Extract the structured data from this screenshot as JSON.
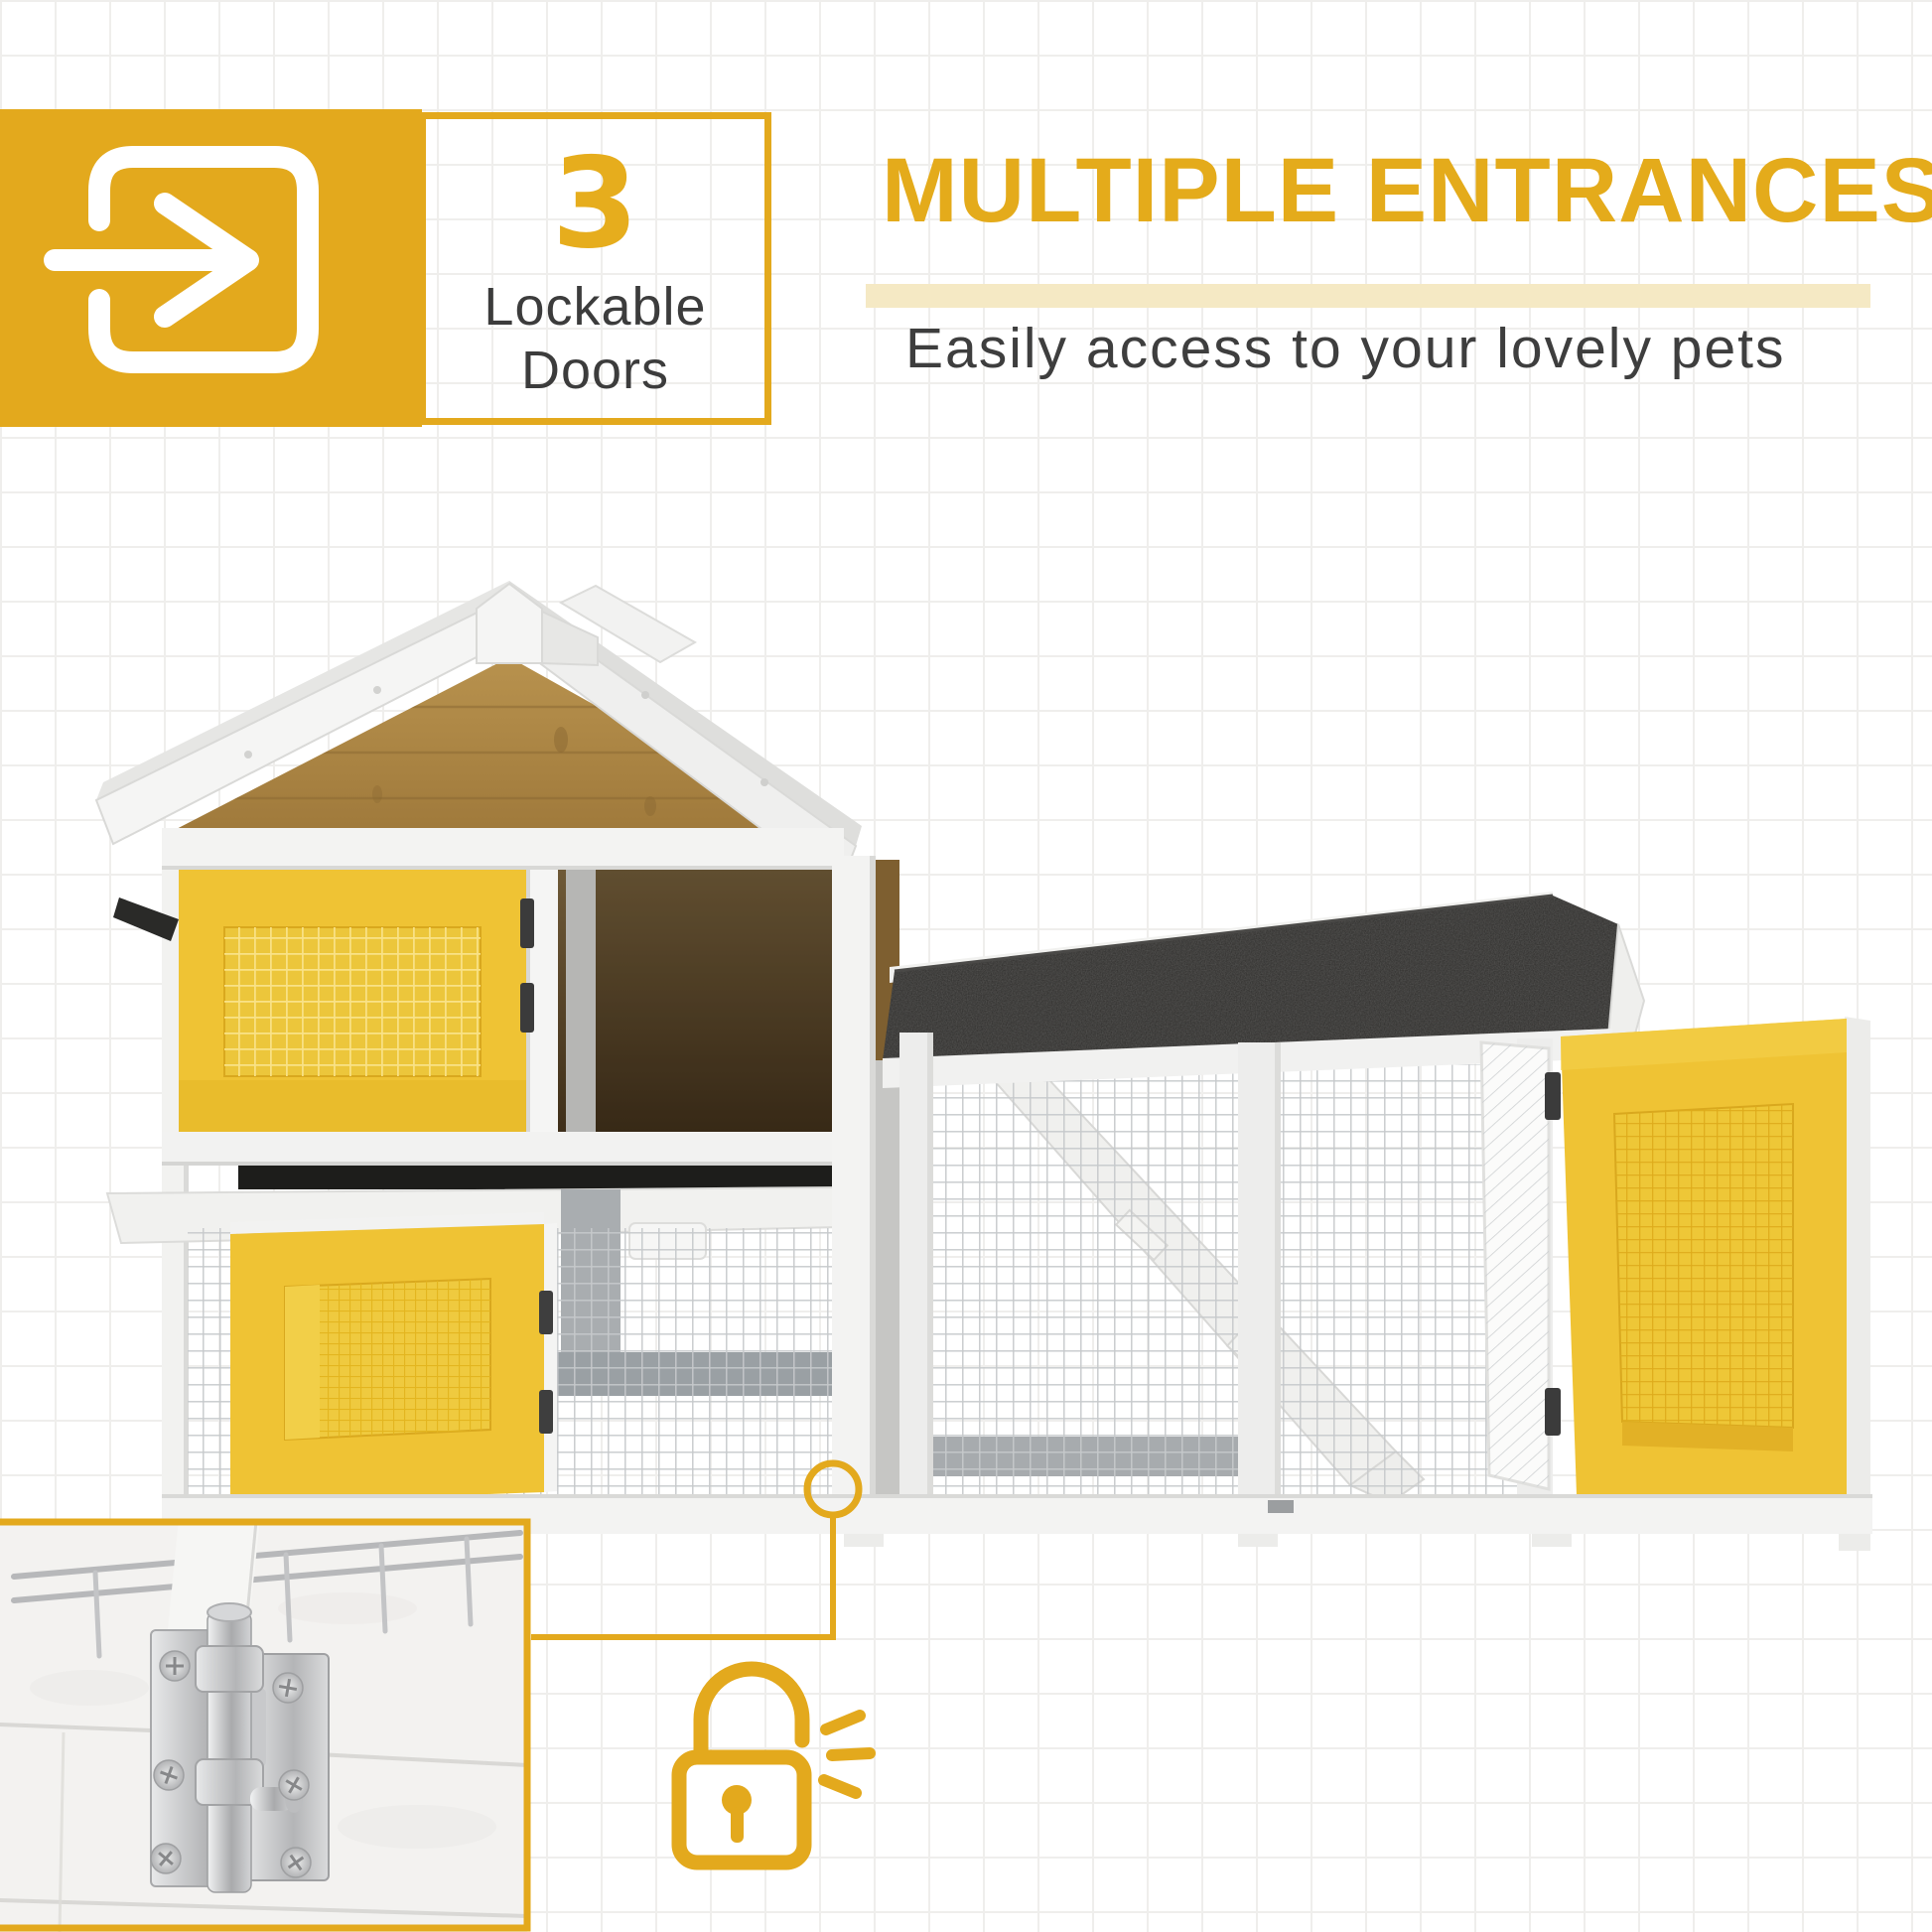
{
  "page": {
    "type": "product-feature-graphic",
    "canvas": "1946x1946"
  },
  "badge": {
    "icon": "enter-door-icon",
    "count": "3",
    "label_line1": "Lockable",
    "label_line2": "Doors"
  },
  "headline": {
    "title": "MULTIPLE ENTRANCES",
    "subtitle": "Easily access to your lovely pets"
  },
  "callout": {
    "marker_icon": "ring-marker",
    "padlock_icon": "open-padlock-icon",
    "inset_photo": "bolt-latch-close-up"
  },
  "palette": {
    "brand_yellow": "#E3A91D",
    "highlight_band": "#F5E9C4",
    "door_yellow": "#EFC334",
    "text_dark": "#3C3C3C",
    "roof_black": "#2D2C2A",
    "wood_brown": "#A8823F",
    "frame_white": "#F4F4F3"
  },
  "illustration": {
    "subject": "two-tier wooden pet hutch with mesh run",
    "visible_parts": [
      "gable roof",
      "wood gable panel",
      "yellow mesh doors",
      "pull-out tray",
      "wire mesh run",
      "interior ramp",
      "asphalt run roof",
      "metal bolt latch close-up"
    ]
  }
}
